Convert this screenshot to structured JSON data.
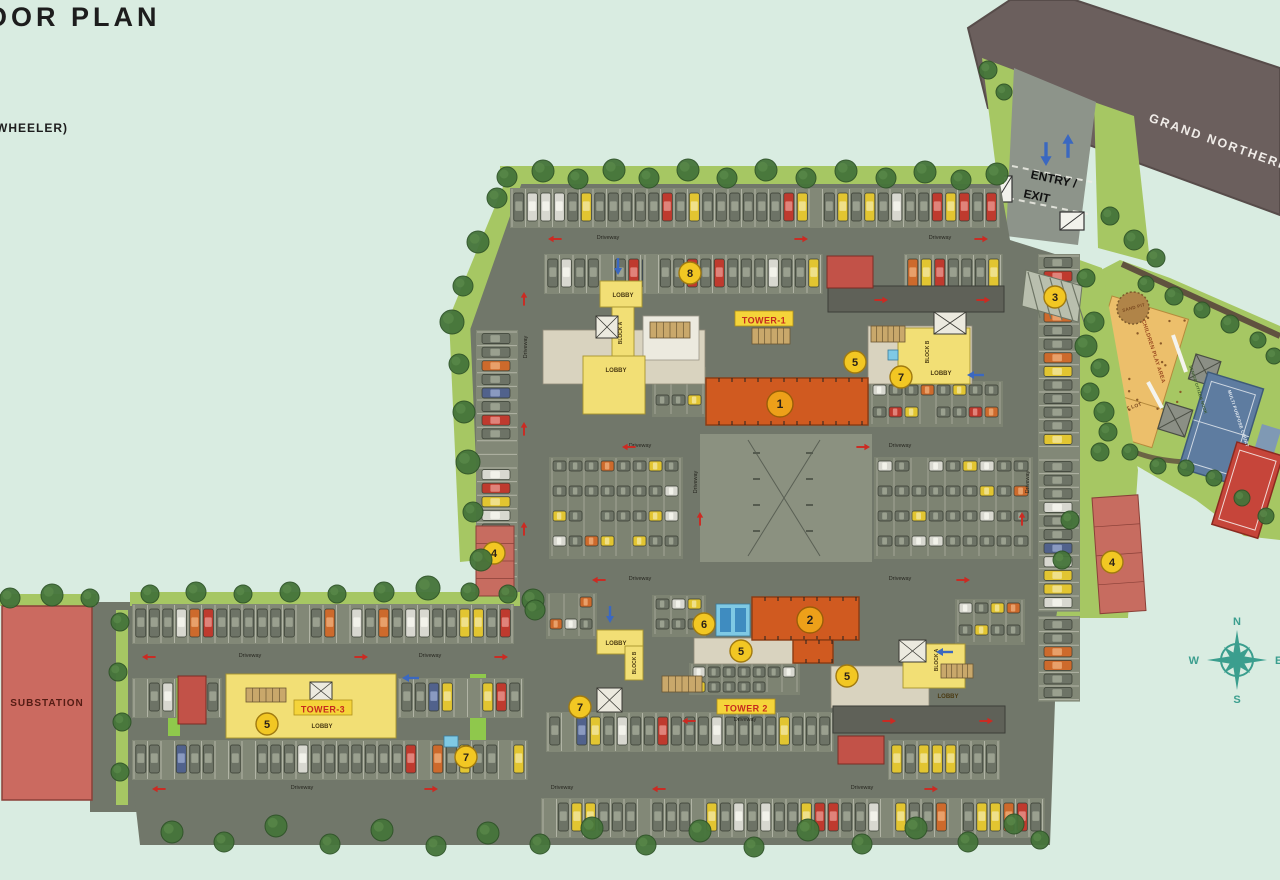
{
  "title": {
    "main": "OOR PLAN",
    "sub": "WHEELER)"
  },
  "road": {
    "label": "GRAND NORTHERN"
  },
  "entry": {
    "line1": "ENTRY /",
    "line2": "EXIT"
  },
  "compass": {
    "n": "N",
    "e": "E",
    "s": "S",
    "w": "W"
  },
  "substation_label": "SUBSTATION",
  "driveway_label": "Driveway",
  "colors": {
    "bg": "#d9ece1",
    "road": "#71776a",
    "strip": "#828877",
    "stall": "#d9d9cb",
    "darkroad": "#5f6158",
    "green": "#a6c763",
    "brightgreen": "#8fc84c",
    "tree": "#45743a",
    "treeline": "#2f5428",
    "path": "#60523f",
    "orange": "#d05a20",
    "orangedark": "#8a3a12",
    "yellowbld": "#f2df75",
    "beige": "#d9d3bf",
    "white": "#eceadf",
    "cyan": "#7fc9e4",
    "redblock": "#c25248",
    "pink": "#c76c60",
    "substation": "#cb6a60",
    "badge": "#f2c723",
    "badgeorange": "#eda019",
    "hatch": "#b9bfae",
    "mainroad": "#6b5f5d",
    "entryroad": "#8d948a",
    "court": "#5e7ca0",
    "redcourt": "#c6453a",
    "sand": "#b08448",
    "play": "#ecbf6b",
    "compassteal": "#3b9e8e",
    "arrowred": "#cc2a22",
    "arrowblue": "#3b68c0"
  },
  "tower_labels": [
    {
      "t": "TOWER-1",
      "x": 764,
      "y": 320,
      "bx": 735,
      "by": 311
    },
    {
      "t": "TOWER 2",
      "x": 746,
      "y": 708,
      "bx": 717,
      "by": 699
    },
    {
      "t": "TOWER-3",
      "x": 323,
      "y": 709,
      "bx": 294,
      "by": 700
    }
  ],
  "lobby_labels": [
    [
      623,
      297
    ],
    [
      616,
      372
    ],
    [
      941,
      375
    ],
    [
      616,
      645
    ],
    [
      948,
      698
    ],
    [
      322,
      728
    ]
  ],
  "lobby_text": "LOBBY",
  "block_labels": [
    {
      "t": "BLOCK A",
      "x": 622,
      "y": 333
    },
    {
      "t": "BLOCK B",
      "x": 929,
      "y": 352
    },
    {
      "t": "BLOCK B",
      "x": 636,
      "y": 663
    },
    {
      "t": "BLOCK A",
      "x": 938,
      "y": 660
    }
  ],
  "amenity_labels": [
    {
      "t": "SAND PIT",
      "x": 1134,
      "y": 309,
      "s": 4.5,
      "r": -15,
      "c": "#7a4a20"
    },
    {
      "t": "CHILDREN PLAY AREA",
      "x": 1152,
      "y": 352,
      "s": 5.5,
      "r": 72,
      "c": "#9a4a20"
    },
    {
      "t": "TOT LOT",
      "x": 1131,
      "y": 409,
      "s": 5,
      "r": -18,
      "c": "#7a4a20"
    },
    {
      "t": "SENIOR CITIZEN NOOK",
      "x": 1197,
      "y": 390,
      "s": 4,
      "r": 72,
      "c": "#3a5a2a"
    },
    {
      "t": "MULTI PURPOSE COURT",
      "x": 1237,
      "y": 419,
      "s": 4.5,
      "r": 72,
      "c": "#e8eef4"
    }
  ],
  "badges": [
    {
      "n": "8",
      "x": 690,
      "y": 273,
      "k": "y"
    },
    {
      "n": "5",
      "x": 855,
      "y": 362,
      "k": "y"
    },
    {
      "n": "7",
      "x": 901,
      "y": 377,
      "k": "y"
    },
    {
      "n": "3",
      "x": 1055,
      "y": 297,
      "k": "y"
    },
    {
      "n": "4",
      "x": 494,
      "y": 553,
      "k": "y"
    },
    {
      "n": "4",
      "x": 1112,
      "y": 562,
      "k": "y"
    },
    {
      "n": "6",
      "x": 704,
      "y": 624,
      "k": "y"
    },
    {
      "n": "5",
      "x": 741,
      "y": 651,
      "k": "y"
    },
    {
      "n": "5",
      "x": 847,
      "y": 676,
      "k": "y"
    },
    {
      "n": "7",
      "x": 580,
      "y": 707,
      "k": "y"
    },
    {
      "n": "5",
      "x": 267,
      "y": 724,
      "k": "y"
    },
    {
      "n": "7",
      "x": 466,
      "y": 757,
      "k": "y"
    },
    {
      "n": "1",
      "x": 780,
      "y": 404,
      "k": "o"
    },
    {
      "n": "2",
      "x": 810,
      "y": 620,
      "k": "o"
    }
  ],
  "driveway_positions": [
    [
      608,
      239,
      0
    ],
    [
      940,
      239,
      0
    ],
    [
      527,
      347,
      -90
    ],
    [
      697,
      482,
      -90
    ],
    [
      1029,
      482,
      -90
    ],
    [
      640,
      447,
      0
    ],
    [
      900,
      447,
      0
    ],
    [
      640,
      580,
      0
    ],
    [
      900,
      580,
      0
    ],
    [
      250,
      657,
      0
    ],
    [
      430,
      657,
      0
    ],
    [
      302,
      789,
      0
    ],
    [
      562,
      789,
      0
    ],
    [
      862,
      789,
      0
    ],
    [
      745,
      721,
      0
    ]
  ],
  "red_arrows": [
    [
      556,
      239,
      180
    ],
    [
      800,
      239,
      0
    ],
    [
      980,
      239,
      0
    ],
    [
      524,
      300,
      -90
    ],
    [
      524,
      430,
      -90
    ],
    [
      524,
      530,
      -90
    ],
    [
      630,
      447,
      180
    ],
    [
      862,
      447,
      0
    ],
    [
      700,
      520,
      -90
    ],
    [
      1022,
      520,
      -90
    ],
    [
      600,
      580,
      180
    ],
    [
      962,
      580,
      0
    ],
    [
      150,
      657,
      180
    ],
    [
      360,
      657,
      0
    ],
    [
      500,
      657,
      0
    ],
    [
      160,
      789,
      180
    ],
    [
      430,
      789,
      0
    ],
    [
      660,
      789,
      180
    ],
    [
      930,
      789,
      0
    ],
    [
      880,
      300,
      0
    ],
    [
      982,
      300,
      0
    ],
    [
      888,
      721,
      0
    ],
    [
      985,
      721,
      0
    ],
    [
      690,
      721,
      180
    ]
  ],
  "blue_arrows": [
    [
      1046,
      152,
      180,
      1.4
    ],
    [
      1068,
      148,
      0,
      1.4
    ],
    [
      618,
      265,
      180,
      1
    ],
    [
      610,
      613,
      180,
      1
    ],
    [
      946,
      652,
      -90,
      1
    ],
    [
      977,
      375,
      -90,
      1
    ],
    [
      412,
      678,
      -90,
      1
    ]
  ],
  "site_polygon": [
    [
      505,
      182
    ],
    [
      1000,
      183
    ],
    [
      1010,
      240
    ],
    [
      1074,
      260
    ],
    [
      1080,
      470
    ],
    [
      1058,
      615
    ],
    [
      1050,
      845
    ],
    [
      140,
      845
    ],
    [
      114,
      615
    ],
    [
      497,
      605
    ],
    [
      475,
      555
    ],
    [
      452,
      318
    ]
  ],
  "road_polygon": [
    [
      968,
      28
    ],
    [
      1010,
      0
    ],
    [
      1075,
      0
    ],
    [
      1280,
      68
    ],
    [
      1280,
      215
    ],
    [
      988,
      108
    ]
  ],
  "entry_road_polygon": [
    [
      1014,
      68
    ],
    [
      1096,
      102
    ],
    [
      1078,
      245
    ],
    [
      1006,
      236
    ]
  ],
  "verges": [
    [
      [
        982,
        58
      ],
      [
        1014,
        70
      ],
      [
        1032,
        230
      ],
      [
        1004,
        232
      ]
    ],
    [
      [
        1094,
        102
      ],
      [
        1134,
        116
      ],
      [
        1150,
        262
      ],
      [
        1098,
        248
      ]
    ]
  ],
  "amenity_polygon": [
    [
      1078,
      282
    ],
    [
      1120,
      260
    ],
    [
      1170,
      278
    ],
    [
      1280,
      326
    ],
    [
      1280,
      540
    ],
    [
      1244,
      536
    ],
    [
      1196,
      500
    ],
    [
      1130,
      462
    ],
    [
      1096,
      428
    ],
    [
      1076,
      352
    ]
  ],
  "green_shapes": [
    {
      "p": [
        [
          500,
          166
        ],
        [
          1004,
          166
        ],
        [
          1004,
          184
        ],
        [
          500,
          184
        ]
      ]
    },
    {
      "p": [
        [
          449,
          318
        ],
        [
          505,
          182
        ],
        [
          522,
          182
        ],
        [
          470,
          330
        ]
      ]
    },
    {
      "p": [
        [
          449,
          318
        ],
        [
          470,
          320
        ],
        [
          480,
          560
        ],
        [
          460,
          562
        ]
      ]
    },
    {
      "p": [
        [
          1074,
          258
        ],
        [
          1102,
          268
        ],
        [
          1138,
          470
        ],
        [
          1128,
          618
        ],
        [
          1056,
          618
        ],
        [
          1080,
          470
        ]
      ]
    },
    {
      "p": [
        [
          130,
          592
        ],
        [
          520,
          592
        ],
        [
          520,
          606
        ],
        [
          130,
          606
        ]
      ]
    },
    {
      "p": [
        [
          116,
          610
        ],
        [
          128,
          610
        ],
        [
          128,
          805
        ],
        [
          116,
          805
        ]
      ]
    },
    {
      "p": [
        [
          0,
          594
        ],
        [
          96,
          594
        ],
        [
          96,
          606
        ],
        [
          0,
          606
        ]
      ]
    }
  ],
  "bright_greens": [
    [
      560,
      506,
      78,
      13
    ],
    [
      168,
      678,
      12,
      58
    ],
    [
      470,
      674,
      16,
      92
    ]
  ],
  "rows_v": [
    [
      512,
      188,
      36
    ],
    [
      546,
      254,
      11
    ],
    [
      645,
      254,
      13
    ],
    [
      906,
      254,
      7
    ],
    [
      548,
      712,
      21
    ],
    [
      543,
      798,
      37
    ],
    [
      134,
      604,
      28
    ],
    [
      134,
      678,
      3
    ],
    [
      206,
      678,
      1
    ],
    [
      400,
      678,
      9
    ],
    [
      134,
      740,
      29
    ],
    [
      890,
      740,
      8
    ]
  ],
  "cols_h": [
    [
      476,
      332,
      19
    ],
    [
      1038,
      256,
      26
    ],
    [
      1038,
      618,
      6
    ],
    [
      704,
      442,
      5
    ],
    [
      820,
      442,
      5
    ]
  ],
  "grids": [
    [
      552,
      460,
      8,
      4,
      16,
      25
    ],
    [
      877,
      460,
      9,
      4,
      17,
      25
    ],
    [
      655,
      370,
      3,
      2,
      16,
      24
    ],
    [
      872,
      384,
      8,
      2,
      16,
      22
    ],
    [
      549,
      596,
      3,
      2,
      15,
      22
    ],
    [
      958,
      602,
      4,
      2,
      16,
      22
    ],
    [
      692,
      666,
      7,
      2,
      15,
      15
    ],
    [
      655,
      598,
      3,
      2,
      16,
      20
    ]
  ],
  "trees": [
    [
      507,
      177,
      10
    ],
    [
      543,
      171,
      11
    ],
    [
      578,
      179,
      10
    ],
    [
      614,
      170,
      11
    ],
    [
      649,
      178,
      10
    ],
    [
      688,
      170,
      11
    ],
    [
      727,
      178,
      10
    ],
    [
      766,
      170,
      11
    ],
    [
      806,
      178,
      10
    ],
    [
      846,
      171,
      11
    ],
    [
      886,
      178,
      10
    ],
    [
      925,
      172,
      11
    ],
    [
      961,
      180,
      10
    ],
    [
      997,
      174,
      11
    ],
    [
      497,
      198,
      10
    ],
    [
      478,
      242,
      11
    ],
    [
      463,
      286,
      10
    ],
    [
      452,
      322,
      12
    ],
    [
      459,
      364,
      10
    ],
    [
      464,
      412,
      11
    ],
    [
      468,
      462,
      12
    ],
    [
      473,
      512,
      10
    ],
    [
      481,
      560,
      11
    ],
    [
      1086,
      278,
      9
    ],
    [
      1094,
      322,
      10
    ],
    [
      1100,
      368,
      9
    ],
    [
      1104,
      412,
      10
    ],
    [
      1100,
      452,
      9
    ],
    [
      1070,
      520,
      9
    ],
    [
      1062,
      560,
      9
    ],
    [
      1146,
      284,
      8
    ],
    [
      1174,
      296,
      9
    ],
    [
      1202,
      310,
      8
    ],
    [
      1230,
      324,
      9
    ],
    [
      1258,
      340,
      8
    ],
    [
      1274,
      356,
      8
    ],
    [
      1086,
      346,
      11
    ],
    [
      1090,
      392,
      9
    ],
    [
      1108,
      432,
      9
    ],
    [
      1130,
      452,
      8
    ],
    [
      1158,
      466,
      8
    ],
    [
      1186,
      468,
      8
    ],
    [
      1214,
      478,
      8
    ],
    [
      1242,
      498,
      8
    ],
    [
      1266,
      516,
      8
    ],
    [
      988,
      70,
      9
    ],
    [
      1004,
      92,
      8
    ],
    [
      1110,
      216,
      9
    ],
    [
      1134,
      240,
      10
    ],
    [
      1156,
      258,
      9
    ],
    [
      150,
      594,
      9
    ],
    [
      196,
      592,
      10
    ],
    [
      243,
      594,
      9
    ],
    [
      290,
      592,
      10
    ],
    [
      337,
      594,
      9
    ],
    [
      384,
      592,
      10
    ],
    [
      428,
      588,
      12
    ],
    [
      470,
      592,
      9
    ],
    [
      508,
      594,
      9
    ],
    [
      533,
      600,
      11
    ],
    [
      535,
      610,
      10
    ],
    [
      120,
      622,
      9
    ],
    [
      118,
      672,
      9
    ],
    [
      122,
      722,
      9
    ],
    [
      120,
      772,
      9
    ],
    [
      10,
      598,
      10
    ],
    [
      52,
      595,
      11
    ],
    [
      90,
      598,
      9
    ],
    [
      172,
      832,
      11
    ],
    [
      224,
      842,
      10
    ],
    [
      276,
      826,
      11
    ],
    [
      330,
      844,
      10
    ],
    [
      382,
      830,
      11
    ],
    [
      436,
      846,
      10
    ],
    [
      488,
      833,
      11
    ],
    [
      540,
      844,
      10
    ],
    [
      592,
      828,
      11
    ],
    [
      646,
      845,
      10
    ],
    [
      700,
      831,
      11
    ],
    [
      754,
      847,
      10
    ],
    [
      808,
      830,
      11
    ],
    [
      862,
      844,
      10
    ],
    [
      916,
      828,
      11
    ],
    [
      968,
      842,
      10
    ],
    [
      1014,
      824,
      10
    ],
    [
      1040,
      840,
      9
    ]
  ],
  "buildings": {
    "towers": [
      [
        706,
        378,
        162,
        47
      ],
      [
        752,
        597,
        107,
        43
      ],
      [
        793,
        640,
        40,
        23
      ]
    ],
    "beige": [
      [
        543,
        330,
        162,
        54
      ],
      [
        868,
        326,
        104,
        58
      ],
      [
        694,
        638,
        100,
        26
      ],
      [
        831,
        666,
        98,
        42
      ]
    ],
    "yellow": [
      [
        600,
        281,
        42,
        26
      ],
      [
        612,
        307,
        22,
        54
      ],
      [
        583,
        356,
        62,
        58
      ],
      [
        898,
        328,
        72,
        56
      ],
      [
        597,
        630,
        46,
        24
      ],
      [
        625,
        646,
        18,
        34
      ],
      [
        903,
        644,
        62,
        44
      ],
      [
        226,
        674,
        170,
        64
      ]
    ],
    "white_pads": [
      [
        300,
        676,
        60,
        22
      ],
      [
        240,
        700,
        52,
        36
      ],
      [
        643,
        316,
        56,
        44
      ]
    ],
    "cores": [
      [
        596,
        316,
        22,
        22
      ],
      [
        934,
        312,
        32,
        22
      ],
      [
        597,
        688,
        25,
        24
      ],
      [
        899,
        640,
        27,
        22
      ],
      [
        310,
        682,
        22,
        18
      ]
    ],
    "stairs": [
      [
        650,
        322,
        40,
        16
      ],
      [
        871,
        326,
        34,
        16
      ],
      [
        752,
        328,
        38,
        16
      ],
      [
        662,
        676,
        40,
        16
      ],
      [
        941,
        664,
        32,
        14
      ],
      [
        246,
        688,
        40,
        14
      ]
    ],
    "red_blocks": [
      [
        827,
        256,
        46,
        32
      ],
      [
        838,
        736,
        46,
        28
      ],
      [
        178,
        676,
        28,
        48
      ]
    ],
    "ramps_dark": [
      [
        828,
        286,
        176,
        26
      ],
      [
        833,
        706,
        172,
        27
      ]
    ],
    "cyan": [
      [
        716,
        604,
        34,
        32
      ],
      [
        888,
        350,
        10,
        10
      ],
      [
        444,
        736,
        14,
        11
      ]
    ],
    "pink4": [
      [
        476,
        526,
        38,
        70,
        0
      ],
      [
        1092,
        498,
        46,
        116,
        -4
      ]
    ],
    "substation": [
      2,
      606,
      90,
      194
    ]
  },
  "center_court": {
    "rect": [
      700,
      434,
      172,
      128
    ]
  },
  "hatch_area": [
    [
      1026,
      270
    ],
    [
      1082,
      286
    ],
    [
      1078,
      322
    ],
    [
      1022,
      306
    ]
  ],
  "gates": [
    [
      996,
      176,
      16,
      26
    ],
    [
      1060,
      212,
      24,
      18
    ]
  ],
  "play_area": {
    "x": 1112,
    "y": 296,
    "w": 80,
    "h": 125,
    "rot": 17
  },
  "tot_lot": {
    "x": 1110,
    "y": 393,
    "w": 56,
    "h": 40,
    "rot": 17
  },
  "sand_pit": {
    "cx": 1133,
    "cy": 308,
    "r": 16
  },
  "gazebos": [
    [
      1196,
      354,
      26,
      26
    ],
    [
      1166,
      402,
      28,
      28
    ]
  ],
  "mp_court": {
    "x": 1208,
    "y": 372,
    "w": 58,
    "h": 100,
    "rot": 17
  },
  "small_pad": {
    "x": 1262,
    "y": 424,
    "w": 20,
    "h": 40,
    "rot": 17
  },
  "red_court": {
    "x": 1237,
    "y": 442,
    "w": 48,
    "h": 86,
    "rot": 17
  },
  "compass_pos": {
    "cx": 1237,
    "cy": 660,
    "r": 30
  }
}
